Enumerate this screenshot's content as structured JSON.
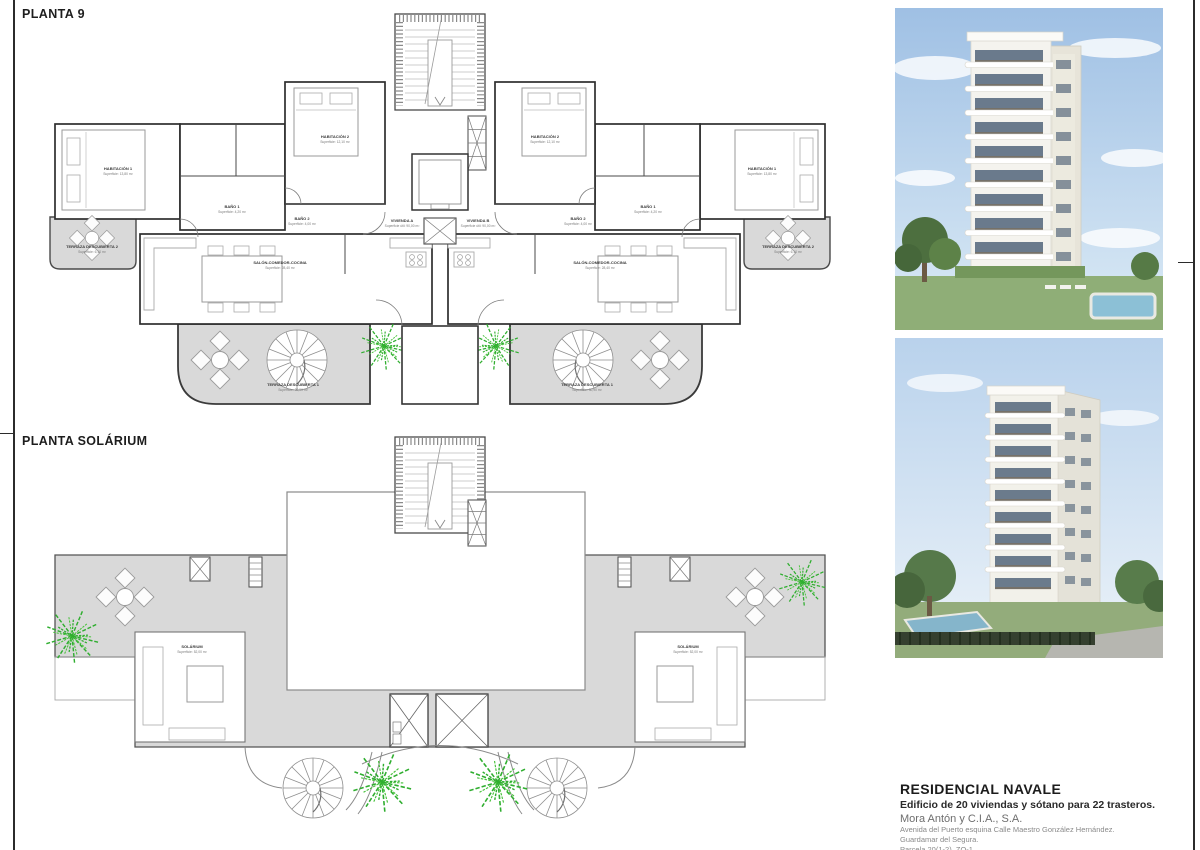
{
  "page": {
    "plan9_title": "PLANTA 9",
    "solarium_title": "PLANTA SOLÁRIUM"
  },
  "plan9": {
    "rooms": {
      "habitacion1": "HABITACIÓN 1",
      "habitacion1_area": "Superficie: 13,80 m²",
      "habitacion2": "HABITACIÓN 2",
      "habitacion2_area": "Superficie: 12,10 m²",
      "bano1": "BAÑO 1",
      "bano1_area": "Superficie: 4,20 m²",
      "bano2": "BAÑO 2",
      "bano2_area": "Superficie: 4,00 m²",
      "salon": "SALÓN-COMEDOR-COCINA",
      "salon_area": "Superficie: 28,40 m²",
      "vivienda_a": "VIVIENDA A",
      "vivienda_a_area": "Superficie útil: 90,00 m²",
      "vivienda_b": "VIVIENDA B",
      "vivienda_b_area": "Superficie útil: 90,00 m²",
      "terraza1": "TERRAZA DESCUBIERTA 1",
      "terraza1_area": "Superficie: 30,90 m²",
      "terraza2": "TERRAZA DESCUBIERTA 2",
      "terraza2_area": "Superficie: 6,10 m²"
    }
  },
  "solarium": {
    "room": "SOLÁRIUM",
    "room_area": "Superficie: 52,00 m²"
  },
  "renders": {
    "photo1": "building-render-day",
    "photo2": "building-render-street"
  },
  "project": {
    "name": "RESIDENCIAL NAVALE",
    "subtitle": "Edificio de 20 viviendas y sótano para 22 trasteros.",
    "company": "Mora Antón y C.I.A., S.A.",
    "address1": "Avenida del Puerto esquina Calle Maestro González Hernández.",
    "address2": "Guardamar del Segura.",
    "address3": "Parcela 20(1-2). ZO-1"
  },
  "colors": {
    "terrace_gray": "#d9d9d9",
    "plant_green": "#2fae2f",
    "wall_dark": "#2e2e2e"
  }
}
